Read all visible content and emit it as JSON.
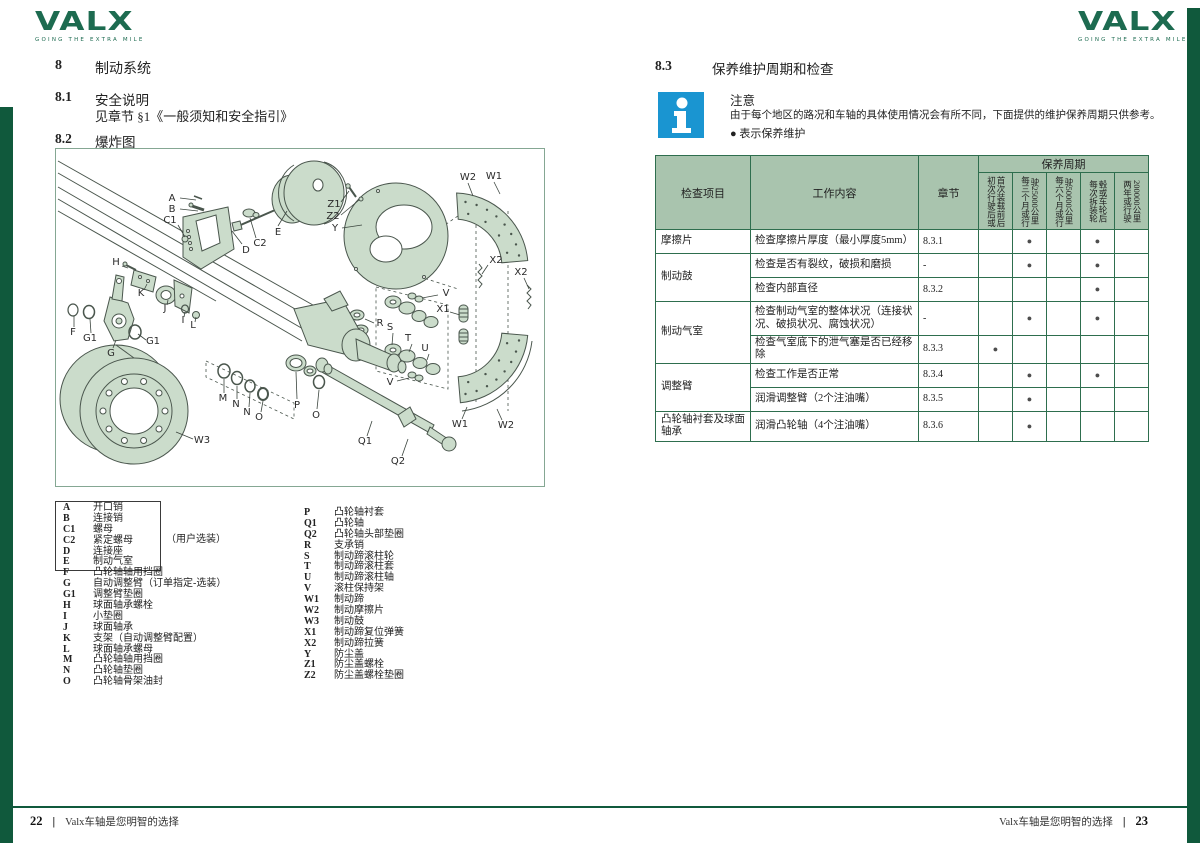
{
  "brand": {
    "logo_text": "VALX",
    "tagline": "GOING THE EXTRA MILE"
  },
  "colors": {
    "brand_green": "#10593c",
    "logo_green": "#1d6b50",
    "diagram_fill": "#cbdccb",
    "table_header_fill": "#a9c4ae",
    "table_border": "#2e6e4e",
    "info_blue": "#1a95d1",
    "dot_gray": "#4d4d4d"
  },
  "left_page": {
    "section8": {
      "num": "8",
      "title": "制动系统"
    },
    "section81": {
      "num": "8.1",
      "title": "安全说明",
      "body": "见章节 §1《一般须知和安全指引》"
    },
    "section82": {
      "num": "8.2",
      "title": "爆炸图"
    },
    "legend": {
      "optional_note": "（用户选装）",
      "left": [
        {
          "code": "A",
          "label": "开口销"
        },
        {
          "code": "B",
          "label": "连接销"
        },
        {
          "code": "C1",
          "label": "螺母"
        },
        {
          "code": "C2",
          "label": "紧定螺母"
        },
        {
          "code": "D",
          "label": "连接座"
        },
        {
          "code": "E",
          "label": "制动气室"
        },
        {
          "code": "F",
          "label": "凸轮轴轴用挡圈"
        },
        {
          "code": "G",
          "label": "自动调整臂（订单指定-选装）"
        },
        {
          "code": "G1",
          "label": "调整臂垫圈"
        },
        {
          "code": "H",
          "label": "球面轴承螺栓"
        },
        {
          "code": "I",
          "label": "小垫圈"
        },
        {
          "code": "J",
          "label": "球面轴承"
        },
        {
          "code": "K",
          "label": "支架（自动调整臂配置）"
        },
        {
          "code": "L",
          "label": "球面轴承螺母"
        },
        {
          "code": "M",
          "label": "凸轮轴轴用挡圈"
        },
        {
          "code": "N",
          "label": "凸轮轴垫圈"
        },
        {
          "code": "O",
          "label": "凸轮轴骨架油封"
        }
      ],
      "right": [
        {
          "code": "P",
          "label": "凸轮轴衬套"
        },
        {
          "code": "Q1",
          "label": "凸轮轴"
        },
        {
          "code": "Q2",
          "label": "凸轮轴头部垫圈"
        },
        {
          "code": "R",
          "label": "支承销"
        },
        {
          "code": "S",
          "label": "制动蹄滚柱轮"
        },
        {
          "code": "T",
          "label": "制动蹄滚柱套"
        },
        {
          "code": "U",
          "label": "制动蹄滚柱轴"
        },
        {
          "code": "V",
          "label": "滚柱保持架"
        },
        {
          "code": "W1",
          "label": "制动蹄"
        },
        {
          "code": "W2",
          "label": "制动摩擦片"
        },
        {
          "code": "W3",
          "label": "制动鼓"
        },
        {
          "code": "X1",
          "label": "制动蹄复位弹簧"
        },
        {
          "code": "X2",
          "label": "制动蹄拉簧"
        },
        {
          "code": "Y",
          "label": "防尘盖"
        },
        {
          "code": "Z1",
          "label": "防尘盖螺栓"
        },
        {
          "code": "Z2",
          "label": "防尘盖螺栓垫圈"
        }
      ]
    },
    "footer": {
      "page": "22",
      "sep": "|",
      "text": "Valx车轴是您明智的选择"
    }
  },
  "right_page": {
    "section83": {
      "num": "8.3",
      "title": "保养维护周期和检查"
    },
    "note": {
      "title": "注意",
      "body": "由于每个地区的路况和车轴的具体使用情况会有所不同，下面提供的维护保养周期只供参考。",
      "legend": "● 表示保养维护"
    },
    "table": {
      "col_item": "检查项目",
      "col_work": "工作内容",
      "col_section": "章节",
      "col_period": "保养周期",
      "dot_char": "●",
      "periods": [
        [
          "初次行驶后或",
          "首次装载前后"
        ],
        [
          "每三个月或行",
          "驶25000公里"
        ],
        [
          "每六个月或行",
          "驶50000公里"
        ],
        [
          "每次拆装轮",
          "毂或车轮后"
        ],
        [
          "两年或行驶",
          "200000公里"
        ]
      ],
      "rows": [
        {
          "item": "摩擦片",
          "rowspan": 1,
          "work": "检查摩擦片厚度（最小厚度5mm）",
          "section": "8.3.1",
          "dots": [
            0,
            1,
            0,
            1,
            0
          ]
        },
        {
          "item": "制动鼓",
          "rowspan": 2,
          "work": "检查是否有裂纹，破损和磨损",
          "section": "-",
          "dots": [
            0,
            1,
            0,
            1,
            0
          ]
        },
        {
          "work": "检查内部直径",
          "section": "8.3.2",
          "dots": [
            0,
            0,
            0,
            1,
            0
          ]
        },
        {
          "item": "制动气室",
          "rowspan": 2,
          "work": "检查制动气室的整体状况（连接状况、破损状况、腐蚀状况）",
          "section": "-",
          "dots": [
            0,
            1,
            0,
            1,
            0
          ],
          "tall": true
        },
        {
          "work": "检查气室底下的泄气塞是否已经移除",
          "section": "8.3.3",
          "dots": [
            1,
            0,
            0,
            0,
            0
          ]
        },
        {
          "item": "调整臂",
          "rowspan": 2,
          "work": "检查工作是否正常",
          "section": "8.3.4",
          "dots": [
            0,
            1,
            0,
            1,
            0
          ]
        },
        {
          "work": "润滑调整臂（2个注油嘴）",
          "section": "8.3.5",
          "dots": [
            0,
            1,
            0,
            0,
            0
          ]
        },
        {
          "item": "凸轮轴衬套及球面轴承",
          "rowspan": 1,
          "work": "润滑凸轮轴（4个注油嘴）",
          "section": "8.3.6",
          "dots": [
            0,
            1,
            0,
            0,
            0
          ]
        }
      ]
    },
    "footer": {
      "text": "Valx车轴是您明智的选择",
      "sep": "|",
      "page": "23"
    }
  },
  "diagram": {
    "labels": [
      {
        "t": "A",
        "x": 116,
        "y": 52,
        "x1": 124,
        "y1": 49,
        "x2": 140,
        "y2": 51
      },
      {
        "t": "B",
        "x": 116,
        "y": 63,
        "x1": 124,
        "y1": 60,
        "x2": 142,
        "y2": 62
      },
      {
        "t": "C1",
        "x": 114,
        "y": 74,
        "x1": 122,
        "y1": 76,
        "x2": 129,
        "y2": 88
      },
      {
        "t": "D",
        "x": 190,
        "y": 104,
        "x1": 186,
        "y1": 95,
        "x2": 176,
        "y2": 82
      },
      {
        "t": "C2",
        "x": 204,
        "y": 97,
        "x1": 200,
        "y1": 89,
        "x2": 194,
        "y2": 69
      },
      {
        "t": "E",
        "x": 222,
        "y": 86,
        "x1": 222,
        "y1": 77,
        "x2": 231,
        "y2": 62
      },
      {
        "t": "Z1",
        "x": 278,
        "y": 58,
        "x1": 285,
        "y1": 53,
        "x2": 293,
        "y2": 42
      },
      {
        "t": "Z2",
        "x": 277,
        "y": 70,
        "x1": 285,
        "y1": 66,
        "x2": 303,
        "y2": 51
      },
      {
        "t": "Y",
        "x": 279,
        "y": 82,
        "x1": 286,
        "y1": 79,
        "x2": 306,
        "y2": 76
      },
      {
        "t": "W2",
        "x": 412,
        "y": 31,
        "x1": 412,
        "y1": 34,
        "x2": 417,
        "y2": 47
      },
      {
        "t": "W1",
        "x": 438,
        "y": 30,
        "x1": 438,
        "y1": 33,
        "x2": 444,
        "y2": 45
      },
      {
        "t": "X2",
        "x": 440,
        "y": 114,
        "x1": 432,
        "y1": 116,
        "x2": 426,
        "y2": 125
      },
      {
        "t": "X2",
        "x": 465,
        "y": 126,
        "x1": 468,
        "y1": 129,
        "x2": 473,
        "y2": 140
      },
      {
        "t": "V",
        "x": 390,
        "y": 147,
        "x1": 382,
        "y1": 146,
        "x2": 366,
        "y2": 149
      },
      {
        "t": "X1",
        "x": 387,
        "y": 163,
        "x1": 394,
        "y1": 163,
        "x2": 404,
        "y2": 166
      },
      {
        "t": "R",
        "x": 324,
        "y": 177,
        "x1": 318,
        "y1": 174,
        "x2": 309,
        "y2": 170
      },
      {
        "t": "S",
        "x": 334,
        "y": 181,
        "x1": 337,
        "y1": 184,
        "x2": 336,
        "y2": 196
      },
      {
        "t": "T",
        "x": 352,
        "y": 192,
        "x1": 356,
        "y1": 195,
        "x2": 353,
        "y2": 203
      },
      {
        "t": "U",
        "x": 369,
        "y": 202,
        "x1": 373,
        "y1": 205,
        "x2": 371,
        "y2": 211
      },
      {
        "t": "V",
        "x": 334,
        "y": 236,
        "x1": 341,
        "y1": 232,
        "x2": 353,
        "y2": 229
      },
      {
        "t": "H",
        "x": 60,
        "y": 116,
        "x1": 66,
        "y1": 117,
        "x2": 72,
        "y2": 119
      },
      {
        "t": "K",
        "x": 85,
        "y": 147,
        "x1": 88,
        "y1": 141,
        "x2": 91,
        "y2": 135
      },
      {
        "t": "J",
        "x": 109,
        "y": 162,
        "x1": 111,
        "y1": 156,
        "x2": 112,
        "y2": 151
      },
      {
        "t": "I",
        "x": 127,
        "y": 174,
        "x1": 128,
        "y1": 168,
        "x2": 129,
        "y2": 163
      },
      {
        "t": "L",
        "x": 137,
        "y": 179,
        "x1": 139,
        "y1": 173,
        "x2": 140,
        "y2": 168
      },
      {
        "t": "F",
        "x": 17,
        "y": 186,
        "x1": 18,
        "y1": 178,
        "x2": 18,
        "y2": 167
      },
      {
        "t": "G1",
        "x": 34,
        "y": 192,
        "x1": 35,
        "y1": 184,
        "x2": 34,
        "y2": 170
      },
      {
        "t": "G",
        "x": 55,
        "y": 207,
        "x1": 57,
        "y1": 199,
        "x2": 60,
        "y2": 191
      },
      {
        "t": "G1",
        "x": 97,
        "y": 195,
        "x1": 90,
        "y1": 191,
        "x2": 82,
        "y2": 185
      },
      {
        "t": "M",
        "x": 167,
        "y": 252,
        "x1": 168,
        "y1": 244,
        "x2": 168,
        "y2": 230
      },
      {
        "t": "N",
        "x": 180,
        "y": 258,
        "x1": 181,
        "y1": 250,
        "x2": 181,
        "y2": 237
      },
      {
        "t": "N",
        "x": 191,
        "y": 266,
        "x1": 193,
        "y1": 258,
        "x2": 194,
        "y2": 244
      },
      {
        "t": "O",
        "x": 203,
        "y": 271,
        "x1": 205,
        "y1": 263,
        "x2": 207,
        "y2": 252
      },
      {
        "t": "P",
        "x": 241,
        "y": 259,
        "x1": 241,
        "y1": 250,
        "x2": 240,
        "y2": 223
      },
      {
        "t": "O",
        "x": 260,
        "y": 269,
        "x1": 261,
        "y1": 260,
        "x2": 263,
        "y2": 241
      },
      {
        "t": "Q1",
        "x": 309,
        "y": 295,
        "x1": 311,
        "y1": 287,
        "x2": 316,
        "y2": 272
      },
      {
        "t": "Q2",
        "x": 342,
        "y": 315,
        "x1": 346,
        "y1": 307,
        "x2": 352,
        "y2": 290
      },
      {
        "t": "W3",
        "x": 146,
        "y": 294,
        "x1": 137,
        "y1": 290,
        "x2": 120,
        "y2": 283
      },
      {
        "t": "W1",
        "x": 404,
        "y": 278,
        "x1": 406,
        "y1": 270,
        "x2": 411,
        "y2": 258
      },
      {
        "t": "W2",
        "x": 450,
        "y": 279,
        "x1": 446,
        "y1": 271,
        "x2": 441,
        "y2": 260
      }
    ]
  }
}
